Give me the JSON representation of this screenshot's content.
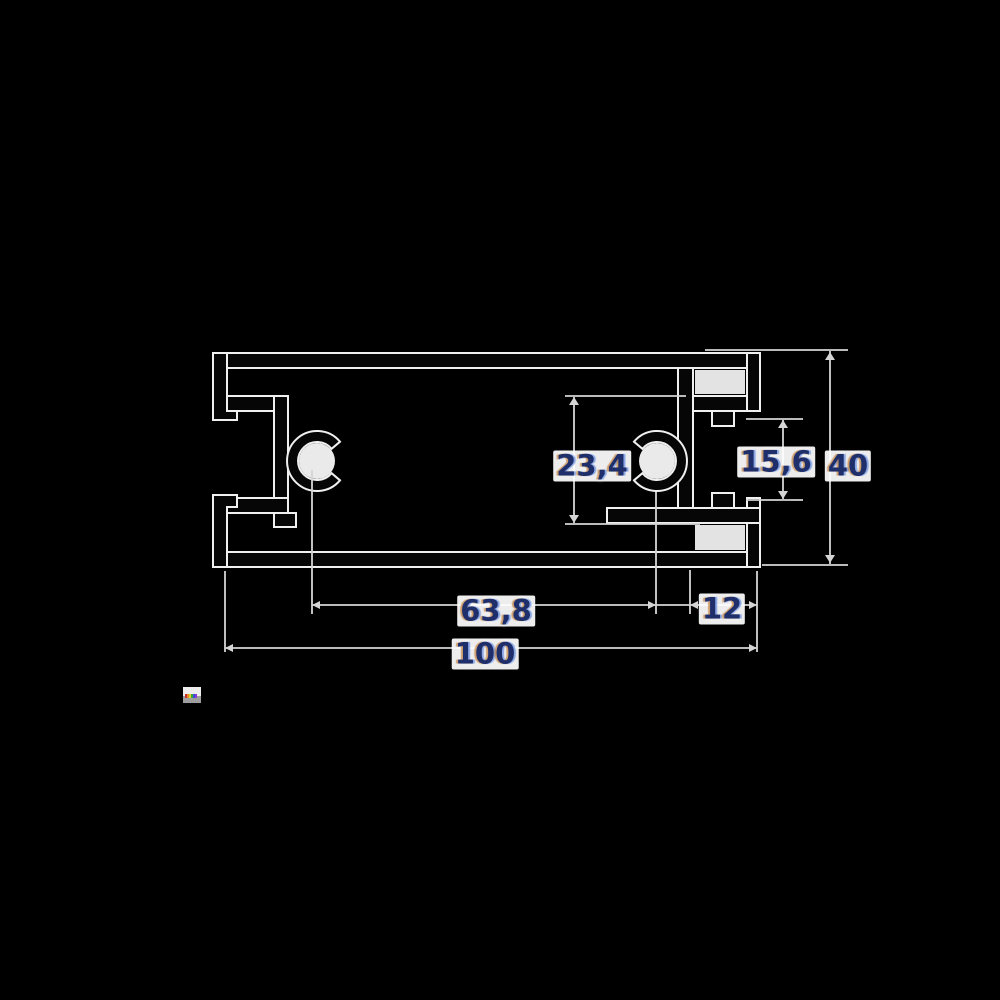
{
  "page": {
    "background_color": "#000000",
    "title": "aluminium-profile-cross-section-drawing"
  },
  "drawing": {
    "type": "technical-profile-cross-section",
    "stroke_halo_color": "#f0f0f0",
    "profile_fill_color": "#060606",
    "dimension_line_color": "#d5d5d5",
    "label_text_color": "#1e2f6b",
    "dimensions": [
      {
        "id": "channel-outer-height",
        "value": "23,4"
      },
      {
        "id": "mouth-opening-height",
        "value": "15,6"
      },
      {
        "id": "total-height",
        "value": "40"
      },
      {
        "id": "boss-center-distance",
        "value": "63,8"
      },
      {
        "id": "right-channel-depth",
        "value": "12"
      },
      {
        "id": "total-width",
        "value": "100"
      }
    ]
  },
  "artifact": {
    "colors": [
      "#c83232",
      "#e08a28",
      "#d8d22a",
      "#3aa83a",
      "#3a50d2",
      "#8a3ad2"
    ]
  }
}
